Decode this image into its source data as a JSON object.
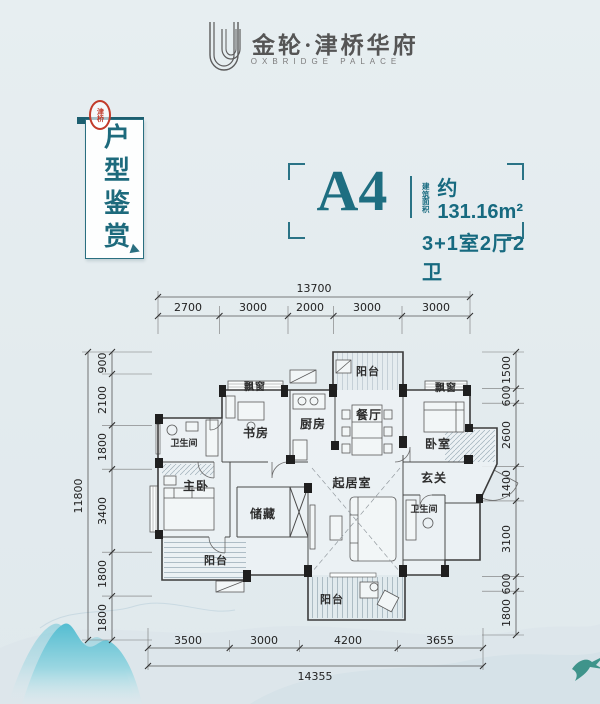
{
  "header": {
    "brand": "金轮·津桥华府",
    "brand_sub": "OXBRIDGE PALACE"
  },
  "banner": {
    "title": "户型鉴赏",
    "seal": "津桥"
  },
  "unit": {
    "name": "A4",
    "area_label": "建筑面积",
    "area": "约131.16m²",
    "layout": "3+1室2厅2卫"
  },
  "plan": {
    "rooms": {
      "balcony_top": "阳台",
      "bay_left": "飘窗",
      "bay_right": "飘窗",
      "study": "书房",
      "kitchen": "厨房",
      "dining": "餐厅",
      "bedroom": "卧室",
      "bath_left": "卫生间",
      "master": "主卧",
      "storage": "储藏",
      "living": "起居室",
      "foyer": "玄关",
      "bath_right": "卫生间",
      "balcony_left": "阳台",
      "balcony_bottom": "阳台"
    },
    "dims": {
      "top_total": "13700",
      "top": [
        "2700",
        "3000",
        "2000",
        "3000",
        "3000"
      ],
      "left_total": "11800",
      "left": [
        "900",
        "2100",
        "1800",
        "3400",
        "1800",
        "1800"
      ],
      "right": [
        "1500",
        "600",
        "2600",
        "1400",
        "3100",
        "600",
        "1800"
      ],
      "bottom": [
        "3500",
        "3000",
        "4200",
        "3655"
      ],
      "bottom_total": "14355"
    }
  },
  "colors": {
    "teal": "#1e6e81",
    "banner_teal": "#1d5f70",
    "seal_red": "#c23b2a",
    "mountain": "#5fc0d2"
  }
}
